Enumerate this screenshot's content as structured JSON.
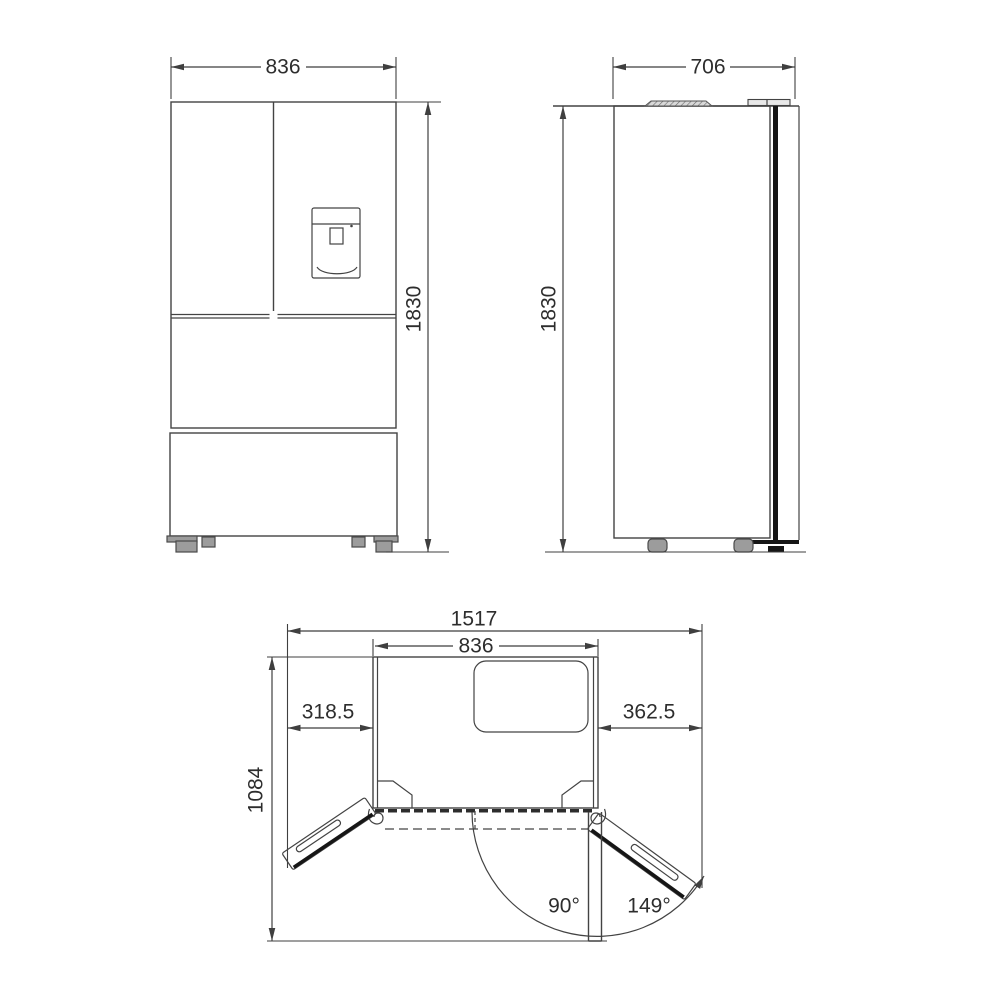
{
  "diagram": {
    "front_view": {
      "width_mm": "836",
      "height_mm": "1830"
    },
    "side_view": {
      "depth_mm": "706",
      "height_mm": "1830"
    },
    "top_view": {
      "overall_width_mm": "1517",
      "cabinet_width_mm": "836",
      "left_door_swing_mm": "318.5",
      "right_door_swing_mm": "362.5",
      "open_depth_mm": "1084",
      "left_door_angle": "90°",
      "right_door_angle": "149°"
    }
  }
}
